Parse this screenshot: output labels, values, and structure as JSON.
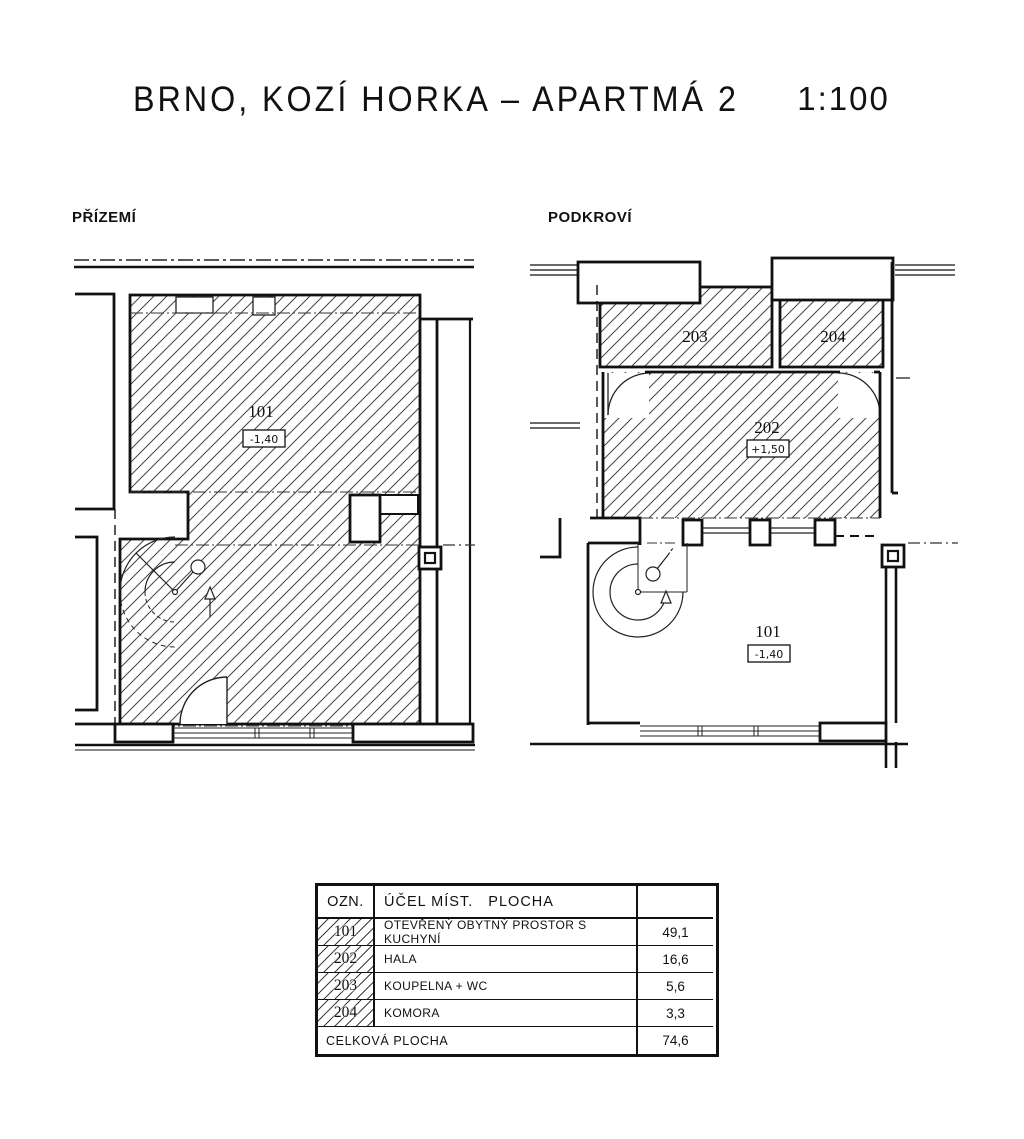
{
  "title": "BRNO, KOZÍ HORKA – APARTMÁ 2",
  "scale": "1:100",
  "plans": {
    "ground": {
      "label": "PŘÍZEMÍ",
      "room": {
        "number": "101",
        "elevation": "-1,40"
      }
    },
    "attic": {
      "label": "PODKROVÍ",
      "room203": {
        "number": "203"
      },
      "room204": {
        "number": "204"
      },
      "room202": {
        "number": "202",
        "elevation": "+1,50"
      },
      "room101": {
        "number": "101",
        "elevation": "-1,40"
      }
    }
  },
  "table": {
    "headers": {
      "ozn": "OZN.",
      "purpose": "ÚČEL MÍST.   PLOCHA",
      "area": ""
    },
    "rows": [
      {
        "ozn": "101",
        "purpose": "OTEVŘENÝ OBYTNÝ PROSTOR S KUCHYNÍ",
        "area": "49,1"
      },
      {
        "ozn": "202",
        "purpose": "HALA",
        "area": "16,6"
      },
      {
        "ozn": "203",
        "purpose": "KOUPELNA + WC",
        "area": "5,6"
      },
      {
        "ozn": "204",
        "purpose": "KOMORA",
        "area": "3,3"
      }
    ],
    "total": {
      "label": "CELKOVÁ PLOCHA",
      "area": "74,6"
    }
  }
}
